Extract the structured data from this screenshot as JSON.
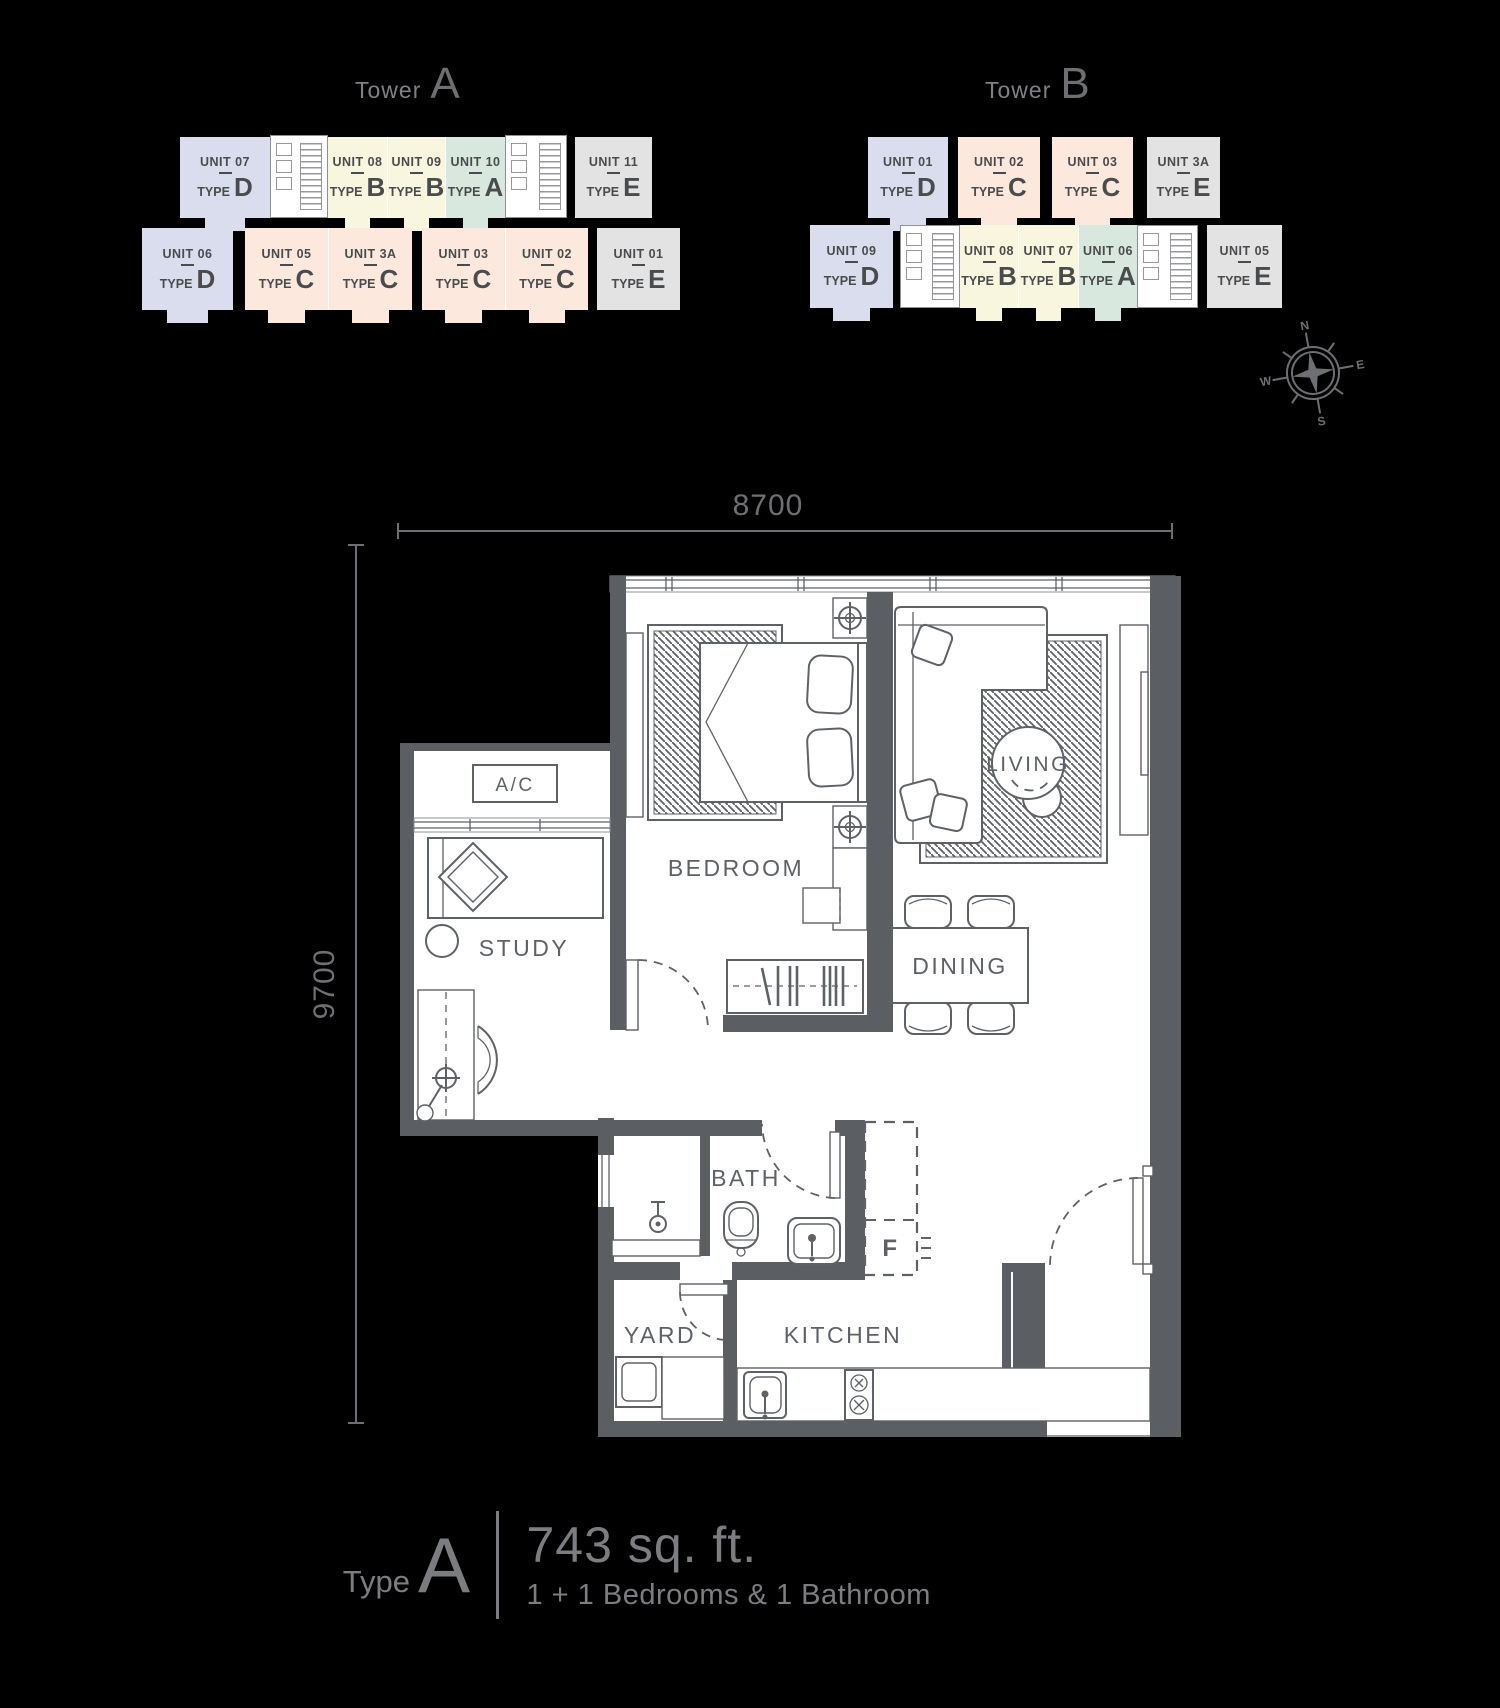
{
  "towers": [
    {
      "word": "Tower",
      "letter": "A",
      "units": [
        {
          "unit": "UNIT 07",
          "type": "D"
        },
        {
          "unit": "UNIT 08",
          "type": "B"
        },
        {
          "unit": "UNIT 09",
          "type": "B"
        },
        {
          "unit": "UNIT 10",
          "type": "A"
        },
        {
          "unit": "UNIT 11",
          "type": "E"
        },
        {
          "unit": "UNIT 06",
          "type": "D"
        },
        {
          "unit": "UNIT 05",
          "type": "C"
        },
        {
          "unit": "UNIT 3A",
          "type": "C"
        },
        {
          "unit": "UNIT 03",
          "type": "C"
        },
        {
          "unit": "UNIT 02",
          "type": "C"
        },
        {
          "unit": "UNIT 01",
          "type": "E"
        }
      ]
    },
    {
      "word": "Tower",
      "letter": "B",
      "units": [
        {
          "unit": "UNIT 01",
          "type": "D"
        },
        {
          "unit": "UNIT 02",
          "type": "C"
        },
        {
          "unit": "UNIT 03",
          "type": "C"
        },
        {
          "unit": "UNIT 3A",
          "type": "E"
        },
        {
          "unit": "UNIT 09",
          "type": "D"
        },
        {
          "unit": "UNIT 08",
          "type": "B"
        },
        {
          "unit": "UNIT 07",
          "type": "B"
        },
        {
          "unit": "UNIT 06",
          "type": "A"
        },
        {
          "unit": "UNIT 05",
          "type": "E"
        }
      ]
    }
  ],
  "ui": {
    "type_word": "TYPE"
  },
  "compass": {
    "n": "N",
    "e": "E",
    "s": "S",
    "w": "W"
  },
  "floor_plan": {
    "dim_width": "8700",
    "dim_height": "9700",
    "rooms": {
      "bedroom": "BEDROOM",
      "study": "STUDY",
      "living": "LIVING",
      "dining": "DINING",
      "bath": "BATH",
      "yard": "YARD",
      "kitchen": "KITCHEN",
      "ac": "A/C",
      "fridge": "F"
    }
  },
  "caption": {
    "type_word": "Type",
    "type_letter": "A",
    "area": "743 sq. ft.",
    "rooms_desc": "1 + 1 Bedrooms & 1 Bathroom"
  },
  "colors": {
    "wall": "#5b5e63",
    "line": "#5e6166",
    "unit_text": "#4a4b4d",
    "title_gray": "#808184",
    "caption_gray": "#7c7d80",
    "dim_gray": "#6d6f72",
    "unit_types": {
      "A": "#d8e8df",
      "B": "#f8f6df",
      "C": "#fce8dd",
      "D": "#d9ddee",
      "E": "#e3e3e4"
    }
  }
}
